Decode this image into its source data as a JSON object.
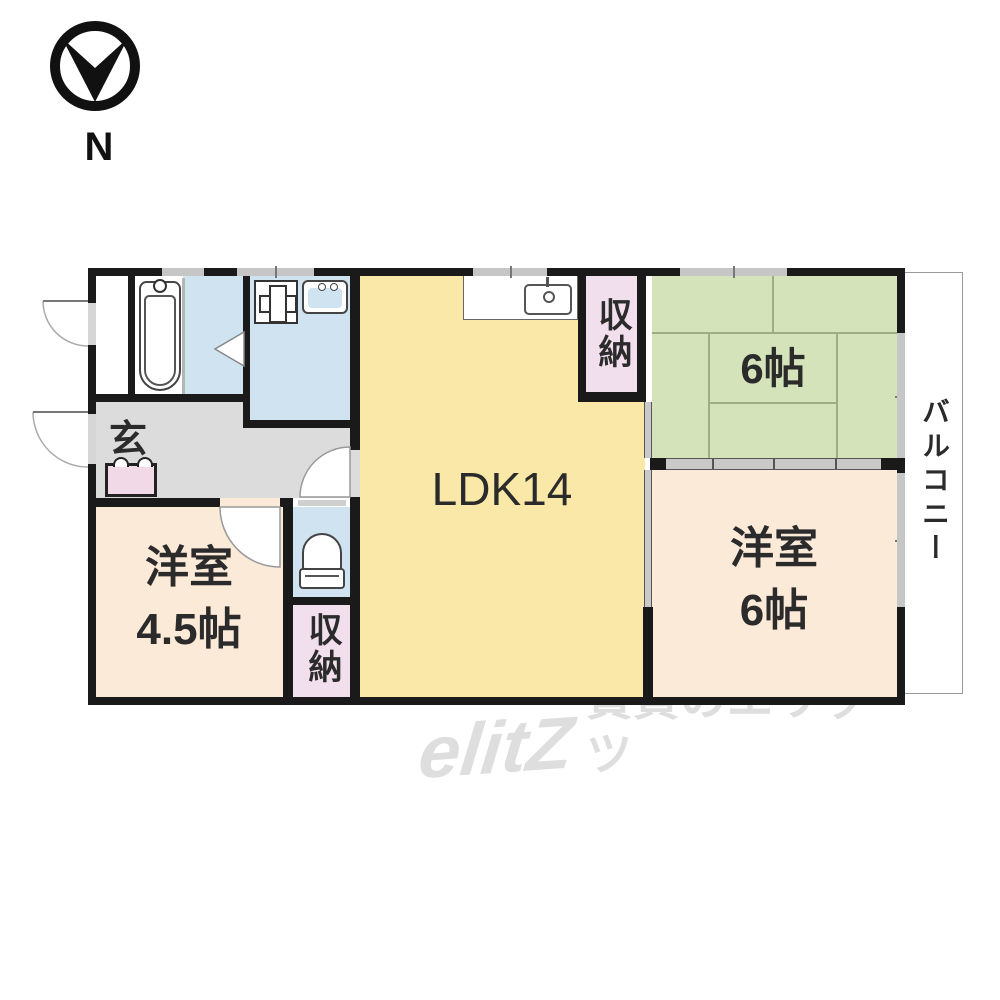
{
  "compass": {
    "north_label": "N"
  },
  "rooms": {
    "ldk": {
      "label": "LDK14"
    },
    "tatami_room": {
      "label": "6帖"
    },
    "western_room_right": {
      "name": "洋室",
      "size": "6帖"
    },
    "western_room_left": {
      "name": "洋室",
      "size": "4.5帖"
    },
    "storage_top": {
      "label": "収納"
    },
    "storage_bottom": {
      "label": "収納"
    },
    "entrance": {
      "label": "玄"
    },
    "balcony": {
      "label": "バルコニー"
    }
  },
  "fixtures": {
    "north_compass": "north-compass-icon",
    "bathtub": "bathtub-icon",
    "washing_machine": "washing-machine-pan-icon",
    "washbasin": "washbasin-icon",
    "kitchen_sink": "kitchen-sink-icon",
    "toilet": "toilet-icon",
    "shoe_cabinet": "shoe-cabinet-icon"
  },
  "colors": {
    "wall": "#1a1a1a",
    "ldk_fill": "#f9e8a8",
    "tatami_fill": "#d4e3ba",
    "western_room_fill": "#fcead9",
    "storage_fill": "#f2dfee",
    "wet_area_fill": "#cfe3f1",
    "hallway_fill": "#dcdcdc",
    "shoe_cabinet_fill": "#f2d9e8",
    "window_gray": "#c6c6c6",
    "watermark_gray": "#dedede"
  },
  "watermark": {
    "logo": "elitZ",
    "text": "賃貸のエリッツ"
  }
}
